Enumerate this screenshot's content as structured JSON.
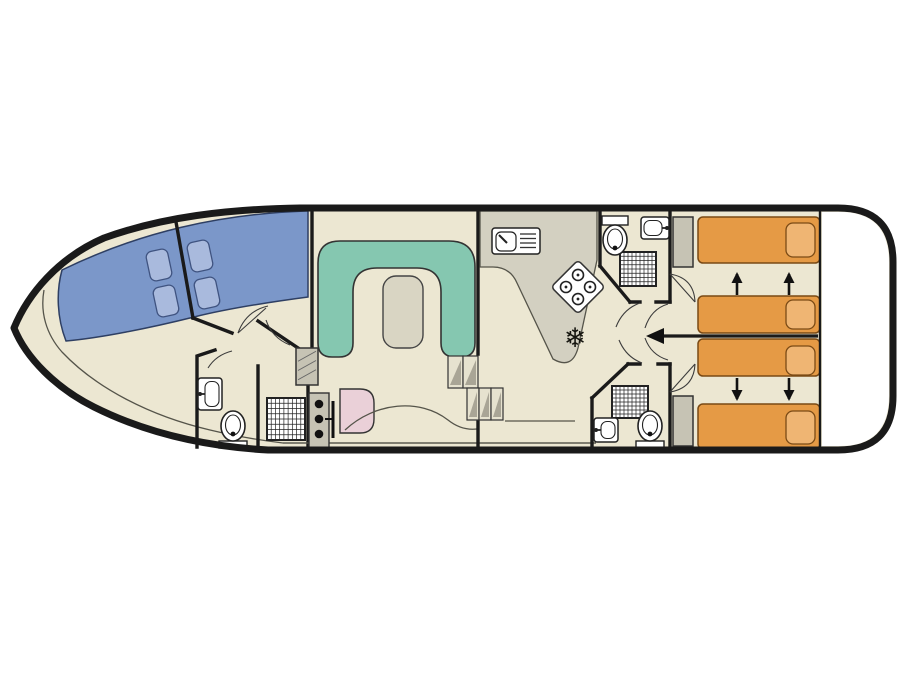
{
  "diagram": {
    "kind": "boat-floor-plan",
    "icons": {
      "freezer": "❄"
    },
    "colors": {
      "floor": "#ece7d2",
      "hull": "#1a1a1a",
      "wall": "#1a1a1a",
      "line": "#55544a",
      "fixstroke": "#222222",
      "blue_berth": "#7b97c9",
      "blue_pillow": "#a9badd",
      "teal_sofa": "#85c7b0",
      "table": "#d9d5c3",
      "orange_bed": "#e59a45",
      "orange_pillow": "#efb573",
      "pink_seat": "#ead0d8",
      "counter": "#d3d0c1",
      "wardrobe": "#c6c3b4",
      "step": "#e6e2cf",
      "step_shade": "#a9a596"
    },
    "plan": {
      "blue_pillows": [
        {
          "cx": 159,
          "cy": 265
        },
        {
          "cx": 166,
          "cy": 301
        },
        {
          "cx": 200,
          "cy": 256
        },
        {
          "cx": 207,
          "cy": 293
        }
      ],
      "beds": [
        {
          "x": 698,
          "y": 217,
          "w": 122,
          "h": 46,
          "px": 786,
          "py": 223,
          "pw": 29,
          "ph": 34
        },
        {
          "x": 698,
          "y": 296,
          "w": 122,
          "h": 37,
          "px": 786,
          "py": 300,
          "pw": 29,
          "ph": 29
        },
        {
          "x": 698,
          "y": 339,
          "w": 122,
          "h": 37,
          "px": 786,
          "py": 346,
          "pw": 29,
          "ph": 29
        },
        {
          "x": 698,
          "y": 404,
          "w": 122,
          "h": 45,
          "px": 786,
          "py": 411,
          "pw": 29,
          "ph": 33
        }
      ],
      "slide_arrows": [
        {
          "x": 737,
          "y1": 295,
          "y2": 274
        },
        {
          "x": 789,
          "y1": 295,
          "y2": 274
        },
        {
          "x": 737,
          "y1": 378,
          "y2": 399
        },
        {
          "x": 789,
          "y1": 378,
          "y2": 399
        }
      ],
      "showers": [
        {
          "x": 620,
          "y": 252,
          "w": 36,
          "h": 34
        },
        {
          "x": 612,
          "y": 386,
          "w": 36,
          "h": 32
        },
        {
          "x": 267,
          "y": 398,
          "w": 38,
          "h": 42
        }
      ],
      "sinks": [
        {
          "x": 198,
          "y": 378,
          "w": 24,
          "h": 32,
          "tap": "left"
        },
        {
          "x": 641,
          "y": 217,
          "w": 28,
          "h": 22,
          "tap": "right"
        },
        {
          "x": 594,
          "y": 418,
          "w": 24,
          "h": 24,
          "tap": "left"
        }
      ],
      "toilets": [
        {
          "cx": 615,
          "cy": 240,
          "tank": "top"
        },
        {
          "cx": 233,
          "cy": 426,
          "tank": "bottom"
        },
        {
          "cx": 650,
          "cy": 426,
          "tank": "bottom"
        }
      ],
      "wardrobes": [
        {
          "x": 673,
          "y": 217,
          "w": 20,
          "h": 50,
          "hatch": false
        },
        {
          "x": 673,
          "y": 396,
          "w": 20,
          "h": 50,
          "hatch": false
        },
        {
          "x": 296,
          "y": 348,
          "w": 22,
          "h": 37,
          "hatch": true
        }
      ],
      "steps": [
        {
          "x": 448,
          "y": 356,
          "w": 30,
          "h": 32,
          "treads": 2
        },
        {
          "x": 467,
          "y": 388,
          "w": 36,
          "h": 32,
          "treads": 3
        }
      ],
      "heater_dots": [
        {
          "cx": 319,
          "cy": 404
        },
        {
          "cx": 319,
          "cy": 419
        },
        {
          "cx": 319,
          "cy": 434
        }
      ]
    }
  }
}
